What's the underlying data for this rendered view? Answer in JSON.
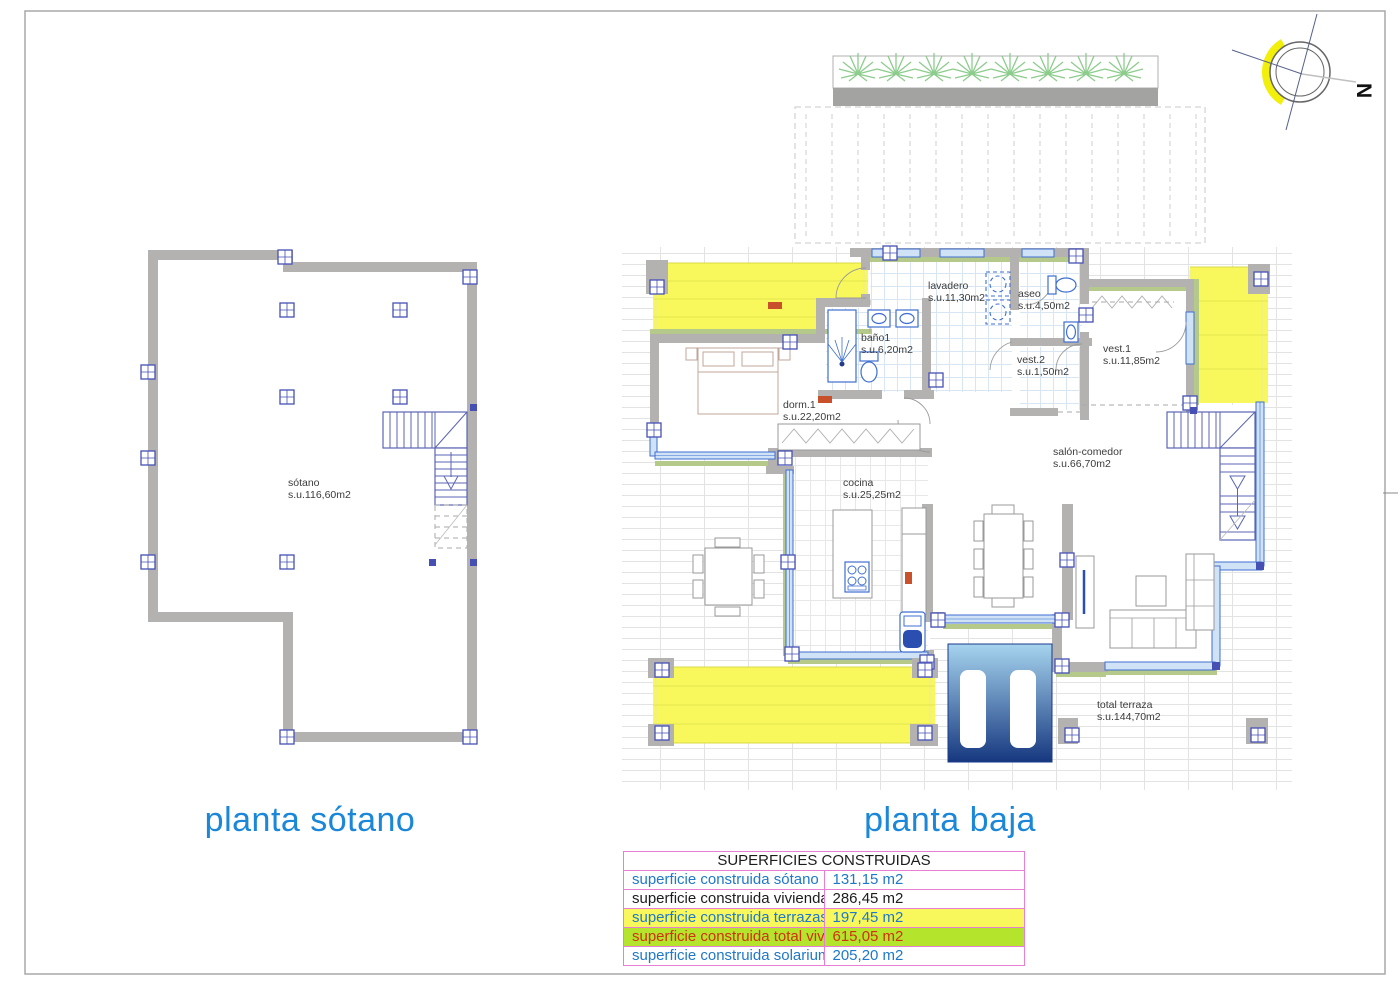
{
  "titles": {
    "sotano": "planta sótano",
    "baja": "planta baja"
  },
  "compass": {
    "north_label": "N"
  },
  "sotano_plan": {
    "room_name": "sótano",
    "room_area": "s.u.116,60m2"
  },
  "baja_plan": {
    "rooms": {
      "lavadero": {
        "name": "lavadero",
        "area": "s.u.11,30m2"
      },
      "aseo": {
        "name": "aseo",
        "area": "s.u.4,50m2"
      },
      "bano1": {
        "name": "baño1",
        "area": "s.u.6,20m2"
      },
      "vest2": {
        "name": "vest.2",
        "area": "s.u.1,50m2"
      },
      "vest1": {
        "name": "vest.1",
        "area": "s.u.11,85m2"
      },
      "dorm1": {
        "name": "dorm.1",
        "area": "s.u.22,20m2"
      },
      "cocina": {
        "name": "cocina",
        "area": "s.u.25,25m2"
      },
      "salon": {
        "name": "salón-comedor",
        "area": "s.u.66,70m2"
      },
      "terraza": {
        "name": "total terraza",
        "area": "s.u.144,70m2"
      }
    }
  },
  "areas_table": {
    "title": "SUPERFICIES CONSTRUIDAS",
    "rows": [
      {
        "label": "superficie construida sótano",
        "value": "131,15 m2"
      },
      {
        "label": "superficie construida vivienda",
        "value": "286,45 m2"
      },
      {
        "label": "superficie construida terrazas",
        "value": "197,45 m2"
      },
      {
        "label": "superficie construida total vivienda",
        "value": "615,05 m2"
      },
      {
        "label": "superficie construida solarium",
        "value": "205,20 m2"
      }
    ]
  },
  "colors": {
    "title_blue": "#1b87d9",
    "table_border_pink": "#e87fd4",
    "table_blue_text": "#1f78c8",
    "table_red_text": "#d03010",
    "terrace_yellow": "#f8f85c",
    "total_row_green": "#b4e42c",
    "wall_gray": "#b4b1b1",
    "accent_green": "#b5c98b",
    "glass_blue": "#3f6fd0",
    "pool_dark_blue": "#16377f"
  }
}
